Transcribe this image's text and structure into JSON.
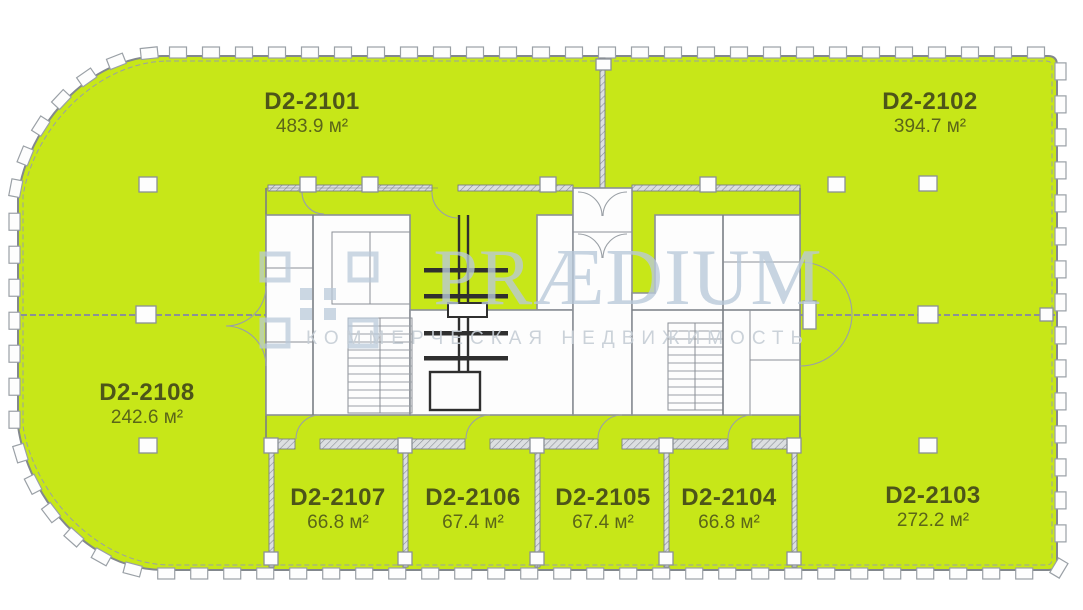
{
  "plan": {
    "units": [
      {
        "id": "D2-2101",
        "area": "483.9 м²"
      },
      {
        "id": "D2-2102",
        "area": "394.7 м²"
      },
      {
        "id": "D2-2103",
        "area": "272.2 м²"
      },
      {
        "id": "D2-2104",
        "area": "66.8 м²"
      },
      {
        "id": "D2-2105",
        "area": "67.4 м²"
      },
      {
        "id": "D2-2106",
        "area": "67.4 м²"
      },
      {
        "id": "D2-2107",
        "area": "66.8 м²"
      },
      {
        "id": "D2-2108",
        "area": "242.6 м²"
      }
    ]
  },
  "watermark": {
    "brand": "PRÆDIUM",
    "tagline": "КОММЕРЧЕСКАЯ НЕДВИЖИМОСТЬ"
  },
  "colors": {
    "unit-fill": "#c7e718",
    "wall": "#83888d",
    "label-text": "#4d5519",
    "watermark": "#b9c9da",
    "tagline": "#c6ced6"
  }
}
